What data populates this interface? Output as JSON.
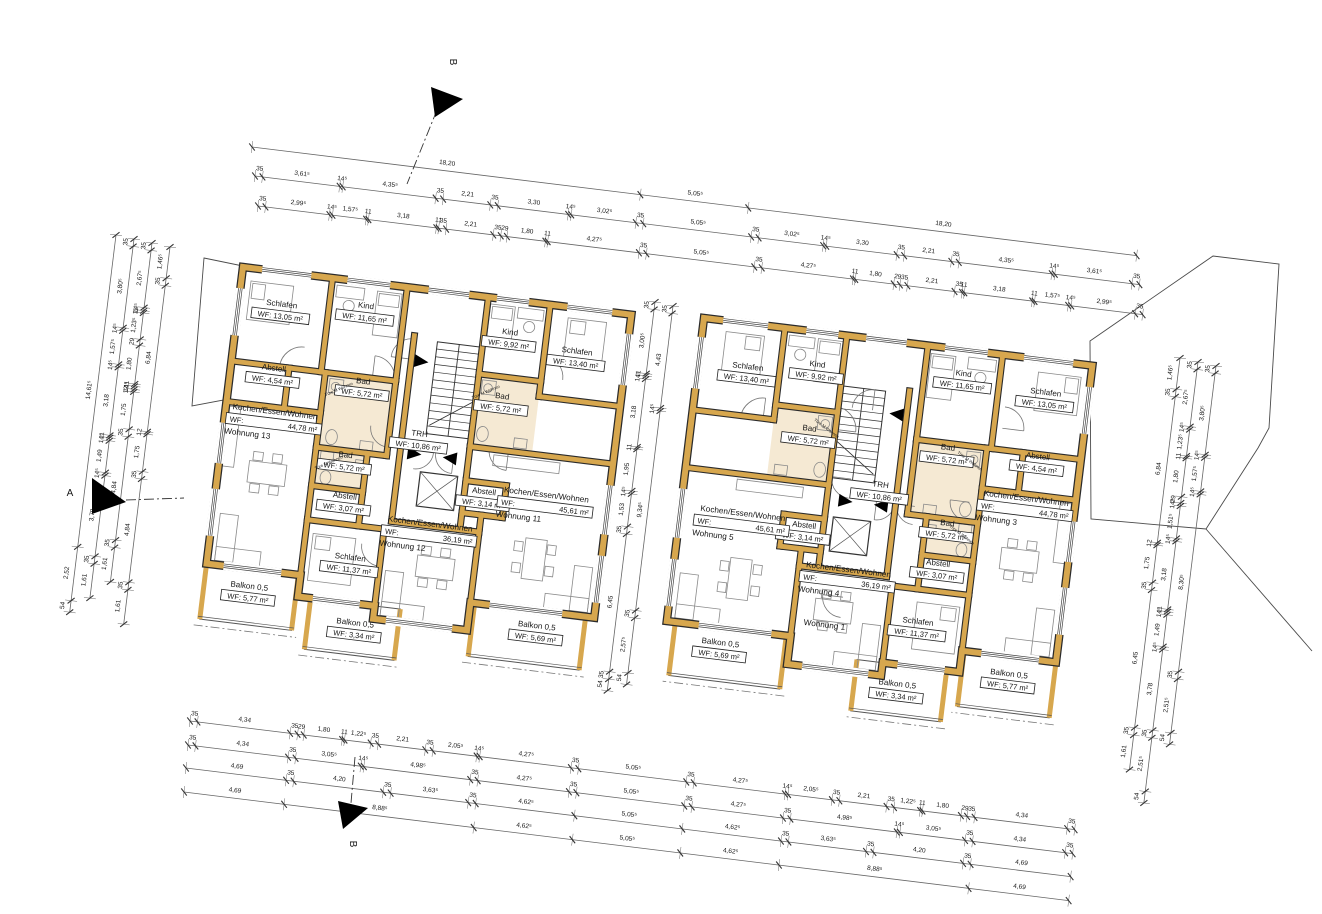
{
  "drawing": {
    "type": "architectural-floor-plan",
    "scale_px_per_m": 21.5,
    "plan_angle_deg": 7,
    "door_note": "Türe M Wohnen",
    "colors": {
      "wall": "#d7a74e",
      "wall_edge": "#2b2b2b",
      "bath_floor": "#f5e9d3",
      "furniture": "#8a8a8a",
      "dim_line": "#666666",
      "text": "#161616"
    },
    "rooms": [
      {
        "id": "schlafen-a",
        "name": "Schlafen",
        "wf": "WF: 13,05 m²",
        "rect": [
          0,
          0,
          4.2,
          4.4
        ],
        "label": [
          2.0,
          1.8
        ],
        "type": "plain"
      },
      {
        "id": "kind-a",
        "name": "Kind",
        "wf": "WF: 11,65 m²",
        "rect": [
          4.2,
          0,
          3.5,
          4.4
        ],
        "label": [
          5.9,
          1.4
        ],
        "type": "plain"
      },
      {
        "id": "kind-b",
        "name": "Kind",
        "wf": "WF: 9,92 m²",
        "rect": [
          11.5,
          0,
          2.9,
          3.6
        ],
        "label": [
          12.7,
          1.8
        ],
        "type": "plain"
      },
      {
        "id": "schlafen-b",
        "name": "Schlafen",
        "wf": "WF: 13,40 m²",
        "rect": [
          14.4,
          0,
          3.8,
          4.3
        ],
        "label": [
          15.9,
          2.3
        ],
        "type": "plain"
      },
      {
        "id": "abstell-a",
        "name": "Abstell",
        "wf": "WF: 4,54 m²",
        "rect": [
          0,
          4.4,
          2.7,
          1.9
        ],
        "label": [
          2.0,
          4.8
        ],
        "type": "plain"
      },
      {
        "id": "bad-a",
        "name": "Bad",
        "wf": "WF: 5,72 m²",
        "rect": [
          4.4,
          4.4,
          3.3,
          3.5
        ],
        "label": [
          6.2,
          4.9
        ],
        "type": "bath"
      },
      {
        "id": "bad-b",
        "name": "Bad",
        "wf": "WF: 5,72 m²",
        "rect": [
          11.5,
          3.6,
          2.9,
          3.4
        ],
        "label": [
          12.7,
          4.8
        ],
        "type": "bath"
      },
      {
        "id": "trh",
        "name": "TRH",
        "wf": "WF: 10,86 m²",
        "rect": [
          8.3,
          2.2,
          3.2,
          8.7
        ],
        "label": [
          9.1,
          7.0
        ],
        "type": "core"
      },
      {
        "id": "bad-c",
        "name": "Bad",
        "wf": "WF: 5,72 m²",
        "rect": [
          4.4,
          7.9,
          2.4,
          1.8
        ],
        "label": [
          5.8,
          8.4
        ],
        "type": "bath"
      },
      {
        "id": "abstell-b",
        "name": "Abstell",
        "wf": "WF: 3,07 m²",
        "rect": [
          4.4,
          9.7,
          2.4,
          1.6
        ],
        "label": [
          6.0,
          10.3
        ],
        "type": "plain"
      },
      {
        "id": "schlafen-c",
        "name": "Schlafen",
        "wf": "WF: 11,37 m²",
        "rect": [
          4.4,
          11.3,
          3.6,
          3.6
        ],
        "label": [
          6.6,
          13.1
        ],
        "type": "plain"
      },
      {
        "id": "abstell-c",
        "name": "Abstell",
        "wf": "WF: 3,14 m²",
        "rect": [
          11.5,
          8.6,
          1.9,
          1.5
        ],
        "label": [
          12.4,
          9.3
        ],
        "type": "plain"
      },
      {
        "id": "kochen-44",
        "name": "Kochen/Essen/Wohnen",
        "wf_label": "WF:",
        "wf_value": "44,78 m²",
        "rect": [
          0,
          6.3,
          4.4,
          7.6
        ],
        "label": [
          2.3,
          6.9
        ],
        "type": "wohnen",
        "apt": 0
      },
      {
        "id": "kochen-36",
        "name": "Kochen/Essen/Wohnen",
        "wf_label": "WF:",
        "wf_value": "36,19 m²",
        "rect": [
          8.0,
          10.1,
          4.4,
          5.4
        ],
        "label": [
          10.1,
          11.2
        ],
        "type": "wohnen",
        "apt": 1
      },
      {
        "id": "kochen-45",
        "name": "Kochen/Essen/Wohnen",
        "wf_label": "WF:",
        "wf_value": "45,61 m²",
        "rect": [
          12.4,
          7.0,
          5.8,
          7.2
        ],
        "label": [
          15.3,
          9.2
        ],
        "type": "wohnen",
        "apt": 2
      },
      {
        "id": "balkon-577",
        "name": "Balkon 0,5",
        "wf": "WF: 5,77 m²",
        "rect": [
          0,
          13.9,
          4.3,
          2.6
        ],
        "label": [
          2.1,
          15.0
        ],
        "type": "balkon"
      },
      {
        "id": "balkon-334",
        "name": "Balkon 0,5",
        "wf": "WF: 3,34 m²",
        "rect": [
          5.0,
          14.9,
          4.2,
          2.4
        ],
        "label": [
          7.2,
          16.1
        ],
        "type": "balkon"
      },
      {
        "id": "balkon-569",
        "name": "Balkon 0,5",
        "wf": "WF: 5,69 m²",
        "rect": [
          12.6,
          14.2,
          5.2,
          2.5
        ],
        "label": [
          15.6,
          15.2
        ],
        "type": "balkon"
      }
    ],
    "buildings": [
      {
        "id": "haus-links",
        "origin": [
          243,
          267
        ],
        "mirror": false,
        "apartments": [
          "Wohnung 13",
          "Wohnung 12",
          "Wohnung 11"
        ]
      },
      {
        "id": "haus-rechts",
        "origin": [
          704,
          318
        ],
        "mirror": true,
        "apartments": [
          "Wohnung 3",
          "Wohnung 4",
          "Wohnung 5"
        ],
        "extra_label": {
          "text": "Wohnung 1",
          "pos": [
            10.9,
            13.6
          ]
        }
      }
    ],
    "dim_chains": [
      {
        "id": "top-1",
        "x": 252,
        "y": 147,
        "d": "h",
        "values": [
          "18,20",
          "5,05⁵",
          "18,20"
        ]
      },
      {
        "id": "top-2",
        "x": 255,
        "y": 176,
        "d": "h",
        "values": [
          "35",
          "3,61⁵",
          "14⁵",
          "4,35⁵",
          "35",
          "2,21",
          "35",
          "3,30",
          "14⁵",
          "3,02⁵",
          "35",
          "5,05⁵",
          "35",
          "3,02⁵",
          "14⁵",
          "3,30",
          "35",
          "2,21",
          "35",
          "4,35⁵",
          "14⁵",
          "3,61⁵",
          "35"
        ]
      },
      {
        "id": "top-3",
        "x": 258,
        "y": 206,
        "d": "h",
        "values": [
          "35",
          "2,99⁵",
          "14⁵",
          "1,57⁵",
          "11",
          "3,18",
          "11",
          "35",
          "2,21",
          "35",
          "29",
          "1,80",
          "11",
          "4,27⁵",
          "35",
          "5,05⁵",
          "35",
          "4,27⁵",
          "11",
          "1,80",
          "29",
          "35",
          "2,21",
          "35",
          "11",
          "3,18",
          "11",
          "1,57⁵",
          "14⁵",
          "2,99⁵",
          "35"
        ]
      },
      {
        "id": "bottom-1",
        "x": 190,
        "y": 721,
        "d": "h",
        "values": [
          "35",
          "4,34",
          "35",
          "29",
          "1,80",
          "11",
          "1,22⁵",
          "35",
          "2,21",
          "35",
          "2,05⁵",
          "14⁵",
          "4,27⁵",
          "35",
          "5,05⁵",
          "35",
          "4,27⁵",
          "14⁵",
          "2,05⁵",
          "35",
          "2,21",
          "35",
          "1,22⁵",
          "11",
          "1,80",
          "29",
          "35",
          "4,34",
          "35"
        ]
      },
      {
        "id": "bottom-2",
        "x": 188,
        "y": 745,
        "d": "h",
        "values": [
          "35",
          "4,34",
          "35",
          "3,05⁵",
          "14⁵",
          "4,98⁵",
          "35",
          "4,27⁵",
          "35",
          "5,05⁵",
          "35",
          "4,27⁵",
          "35",
          "4,98⁵",
          "14⁵",
          "3,05⁵",
          "35",
          "4,34",
          "35"
        ]
      },
      {
        "id": "bottom-3",
        "x": 186,
        "y": 768,
        "d": "h",
        "values": [
          "4,69",
          "35",
          "4,20",
          "35",
          "3,63⁵",
          "35",
          "4,62⁵",
          "5,05⁵",
          "4,62⁵",
          "35",
          "3,63⁵",
          "35",
          "4,20",
          "35",
          "4,69"
        ]
      },
      {
        "id": "bottom-4",
        "x": 184,
        "y": 792,
        "d": "h",
        "values": [
          "4,69",
          "8,88⁵",
          "4,62⁵",
          "5,05⁵",
          "4,62⁵",
          "8,88⁵",
          "4,69"
        ]
      },
      {
        "id": "left-1",
        "x": 116,
        "y": 235,
        "d": "v",
        "values": [
          "14,61⁵",
          "2,52",
          "54"
        ]
      },
      {
        "id": "left-2",
        "x": 134,
        "y": 239,
        "d": "v",
        "values": [
          "35",
          "3,80⁵",
          "14⁵",
          "1,57⁵",
          "14⁵",
          "3,18",
          "11",
          "14⁵",
          "1,49",
          "14⁵",
          "3,78",
          "35",
          "1,61"
        ]
      },
      {
        "id": "left-3",
        "x": 152,
        "y": 243,
        "d": "v",
        "values": [
          "35",
          "2,67⁵",
          "14⁵",
          "11",
          "1,23⁵",
          "29",
          "1,80",
          "11",
          "14⁵",
          "12",
          "1,75",
          "35",
          "4,84",
          "35",
          "1,61"
        ]
      },
      {
        "id": "left-4",
        "x": 170,
        "y": 247,
        "d": "v",
        "values": [
          "1,46⁵",
          "35",
          "6,84",
          "12",
          "1,75",
          "35",
          "4,84",
          "35",
          "1,61"
        ]
      },
      {
        "id": "mid-1",
        "x": 655,
        "y": 302,
        "d": "v",
        "values": [
          "35",
          "3,00⁵",
          "11",
          "14⁵",
          "3,18",
          "11",
          "1,95",
          "14⁵",
          "1,53",
          "35",
          "6,45",
          "35",
          "54"
        ]
      },
      {
        "id": "mid-2",
        "x": 673,
        "y": 306,
        "d": "v",
        "values": [
          "35",
          "4,43",
          "14⁵",
          "9,34⁵",
          "35",
          "2,57⁵",
          "54"
        ]
      },
      {
        "id": "right-1",
        "x": 1180,
        "y": 358,
        "d": "v",
        "values": [
          "1,46⁵",
          "35",
          "6,84",
          "12",
          "1,75",
          "35",
          "6,45",
          "35",
          "1,61"
        ]
      },
      {
        "id": "right-2",
        "x": 1198,
        "y": 362,
        "d": "v",
        "values": [
          "35",
          "2,67⁵",
          "14⁵",
          "1,23⁵",
          "11",
          "1,80",
          "29",
          "14⁵",
          "1,51⁵",
          "14⁵",
          "3,18",
          "11",
          "14⁵",
          "1,49",
          "14⁵",
          "3,78",
          "35",
          "2,51⁵",
          "54"
        ]
      },
      {
        "id": "right-3",
        "x": 1216,
        "y": 366,
        "d": "v",
        "values": [
          "35",
          "3,80⁵",
          "14⁵",
          "1,57⁵",
          "14⁵",
          "8,30⁵",
          "35",
          "2,51⁵",
          "54"
        ]
      }
    ],
    "section_markers": [
      {
        "letter": "A",
        "lx": 70,
        "ly": 496,
        "lrot": 0,
        "tri": [
          [
            92,
            478
          ],
          [
            92,
            514
          ],
          [
            126,
            502
          ]
        ],
        "line": [
          126,
          500,
          184,
          498
        ]
      },
      {
        "letter": "B",
        "lx": 450,
        "ly": 62,
        "lrot": 90,
        "tri": [
          [
            431,
            87
          ],
          [
            463,
            99
          ],
          [
            435,
            117
          ]
        ],
        "line": [
          437,
          110,
          407,
          184
        ]
      },
      {
        "letter": "B",
        "lx": 350,
        "ly": 844,
        "lrot": 90,
        "tri": [
          [
            338,
            801
          ],
          [
            368,
            808
          ],
          [
            343,
            829
          ]
        ],
        "line": [
          355,
          757,
          351,
          803
        ]
      }
    ]
  }
}
